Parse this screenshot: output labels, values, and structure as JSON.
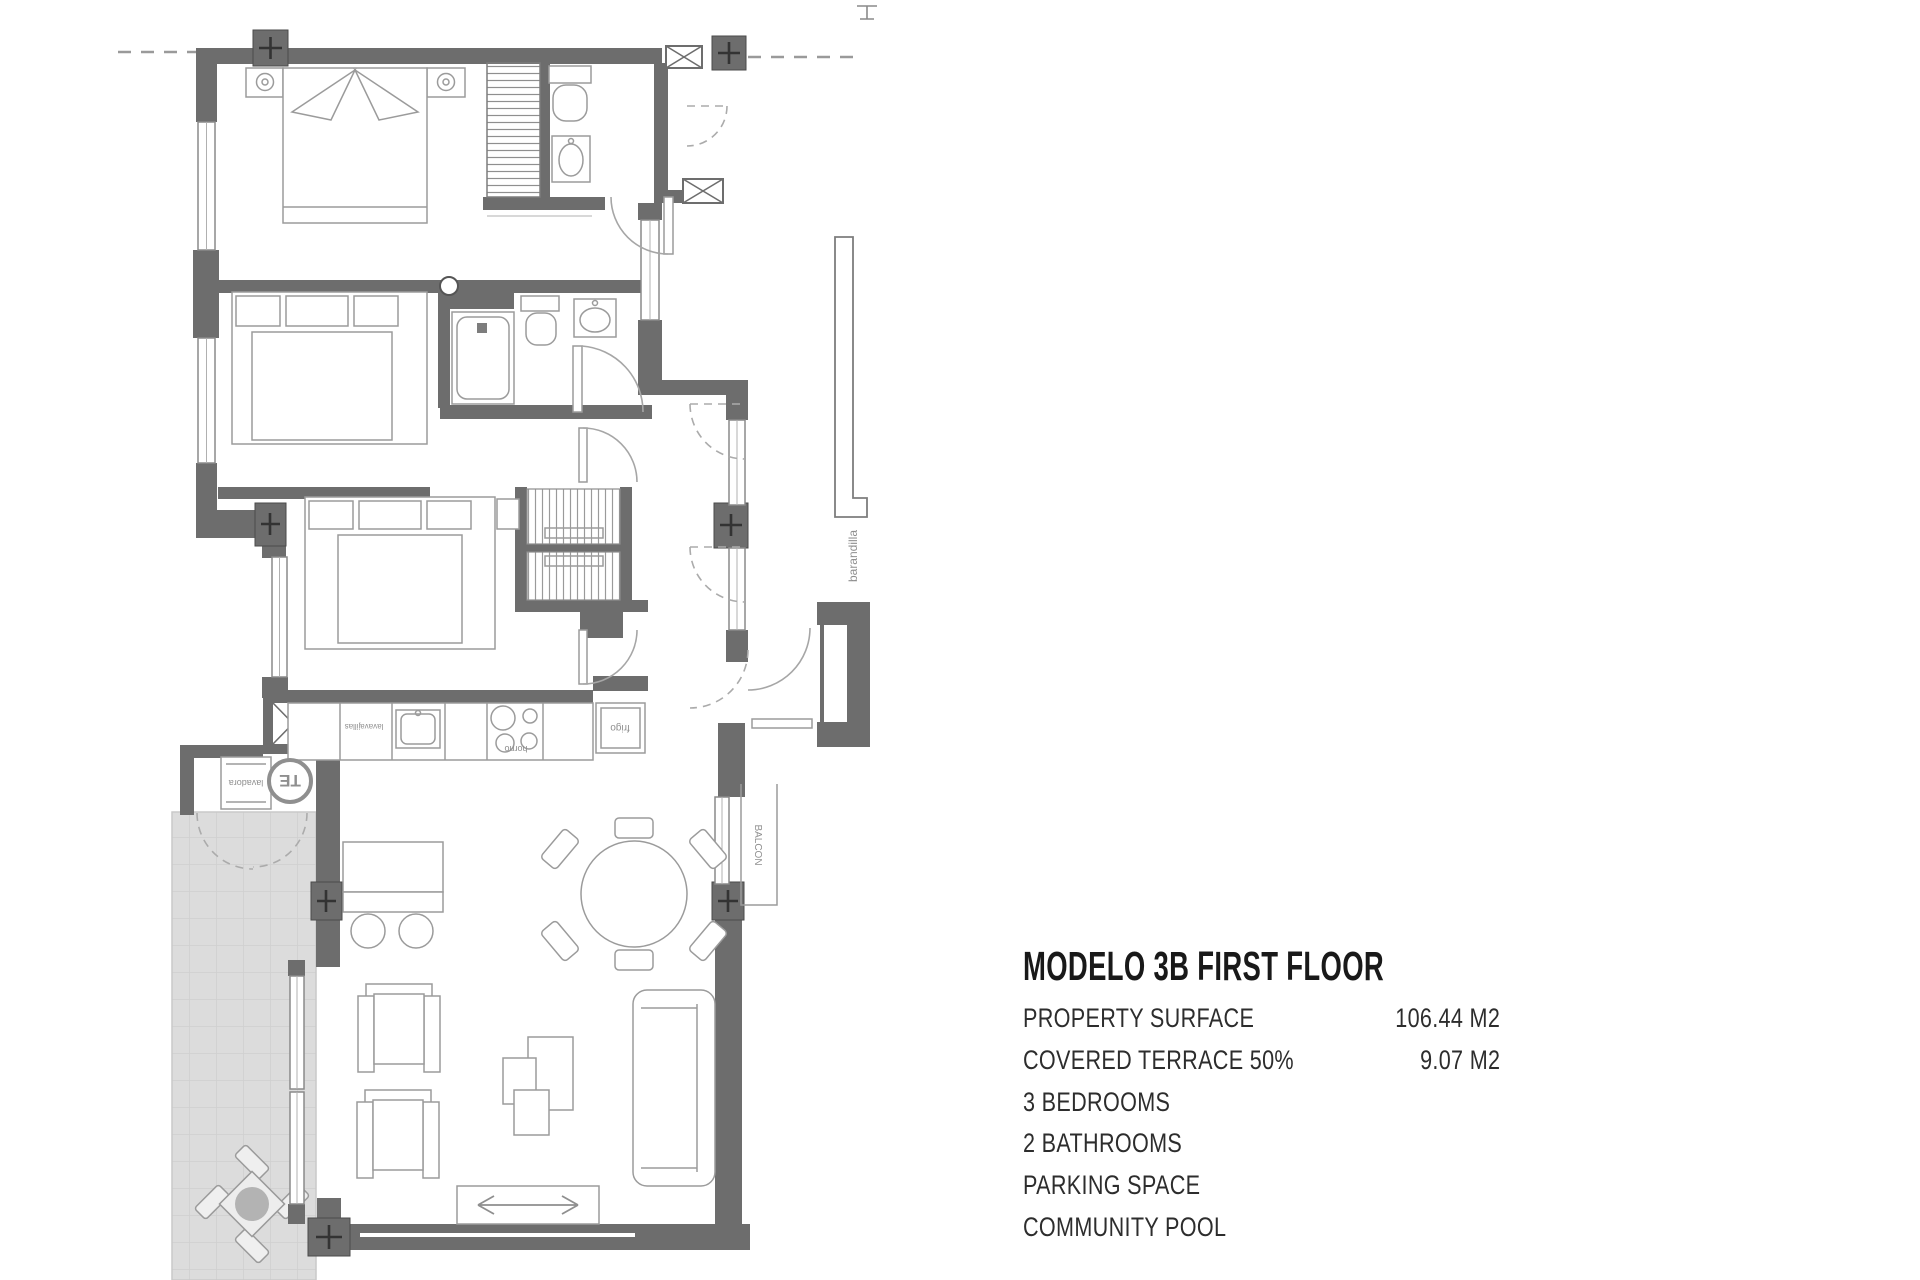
{
  "panel": {
    "title": "MODELO 3B FIRST FLOOR",
    "rows": [
      {
        "label": "PROPERTY SURFACE",
        "value": "106.44 M2"
      },
      {
        "label": "COVERED TERRACE 50%",
        "value": "9.07 M2"
      },
      {
        "label": "3 BEDROOMS",
        "value": ""
      },
      {
        "label": "2 BATHROOMS",
        "value": ""
      },
      {
        "label": "PARKING SPACE",
        "value": ""
      },
      {
        "label": "COMMUNITY POOL",
        "value": ""
      }
    ]
  },
  "plan": {
    "labels": {
      "railing": "barandilla",
      "balcony": "BALCON",
      "water_heater": "TE",
      "washing_machine": "lavadora",
      "dishwasher": "lavavajillas",
      "oven": "horno",
      "fridge": "frigo"
    }
  },
  "colors": {
    "wall": "#6d6d6d",
    "furniture_line": "#9b9b9b",
    "terrace_fill": "#dcdcdc",
    "text": "#2d2d2d"
  }
}
